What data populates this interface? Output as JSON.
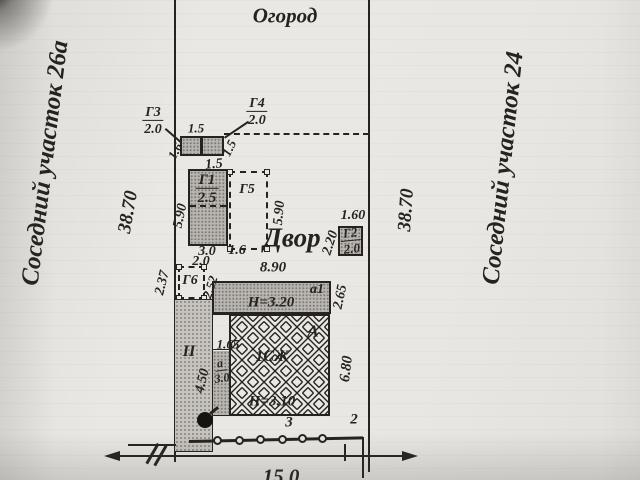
{
  "areas": {
    "garden": "Огород",
    "yard": "Двор",
    "neighbor_left": "Соседний участок  26а",
    "neighbor_right": "Соседний участок  24",
    "zone_ii": "II"
  },
  "plot_dims": {
    "left_side": "38.70",
    "right_side": "38.70",
    "front": "15.0"
  },
  "structures": {
    "g3": {
      "name": "Г3",
      "size": "2.0"
    },
    "g4": {
      "name": "Г4",
      "size": "2.0"
    },
    "g1": {
      "name": "Г1",
      "size": "2.5"
    },
    "g5": {
      "name": "Г5"
    },
    "g6": {
      "name": "Г6"
    },
    "g2": {
      "name": "Г2",
      "size": "2.0"
    },
    "a1": {
      "name": "а1",
      "height": "Н=3.20"
    },
    "main_house": {
      "name": "А",
      "use": "1СЖ",
      "height": "Н=3.10"
    },
    "porch": {
      "name": "а",
      "size": "3.0"
    }
  },
  "dims": {
    "shed_top": "1.5",
    "shed_left": "1.6",
    "shed_right": "1.5",
    "g1_top": "1.5",
    "g1_left": "5.90",
    "g5_right": "5.90",
    "g1_bottom_1": "3.0",
    "g1_bottom_2": "1.6",
    "g6_top": "2.0",
    "g6_left": "2.37",
    "g6_right": "2.52",
    "g2_top": "1.60",
    "g2_left": "2.20",
    "a1_top": "8.90",
    "a1_right": "2.65",
    "house_right": "6.80",
    "porch_top": "1.65",
    "porch_left": "4.50"
  },
  "fence": {
    "point_3": "3",
    "point_2": "2"
  },
  "colors": {
    "paper": "#e9e7e3",
    "ink": "#26231f",
    "fill_gray": "#b9b6b1"
  }
}
